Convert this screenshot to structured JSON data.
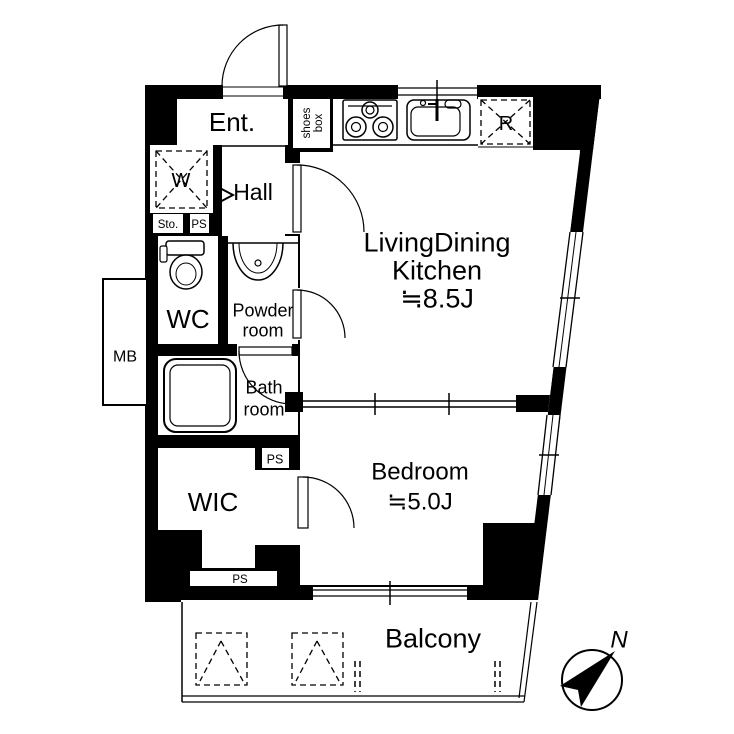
{
  "plan": {
    "type": "apartment-floor-plan",
    "colors": {
      "wall": "#000000",
      "background": "#ffffff",
      "line": "#000000"
    },
    "rooms": {
      "entrance": {
        "label": "Ent."
      },
      "shoes_box": {
        "line1": "shoes",
        "line2": "box"
      },
      "hall": {
        "label": "Hall"
      },
      "washer_space": {
        "label": "W"
      },
      "storage": {
        "label": "Sto."
      },
      "ps_top": {
        "label": "PS"
      },
      "wc": {
        "label": "WC"
      },
      "powder_room": {
        "line1": "Powder",
        "line2": "room"
      },
      "meter_box": {
        "label": "MB"
      },
      "bath_room": {
        "line1": "Bath",
        "line2": "room"
      },
      "ps_mid": {
        "label": "PS"
      },
      "wic": {
        "label": "WIC"
      },
      "ps_bottom": {
        "label": "PS"
      },
      "ldk": {
        "line1": "LivingDining",
        "line2": "Kitchen",
        "line3": "≒8.5J"
      },
      "bedroom": {
        "line1": "Bedroom",
        "line2": "≒5.0J"
      },
      "balcony": {
        "label": "Balcony"
      },
      "refrigerator_space": {
        "label": "R"
      }
    },
    "compass": {
      "north_label": "N"
    }
  }
}
